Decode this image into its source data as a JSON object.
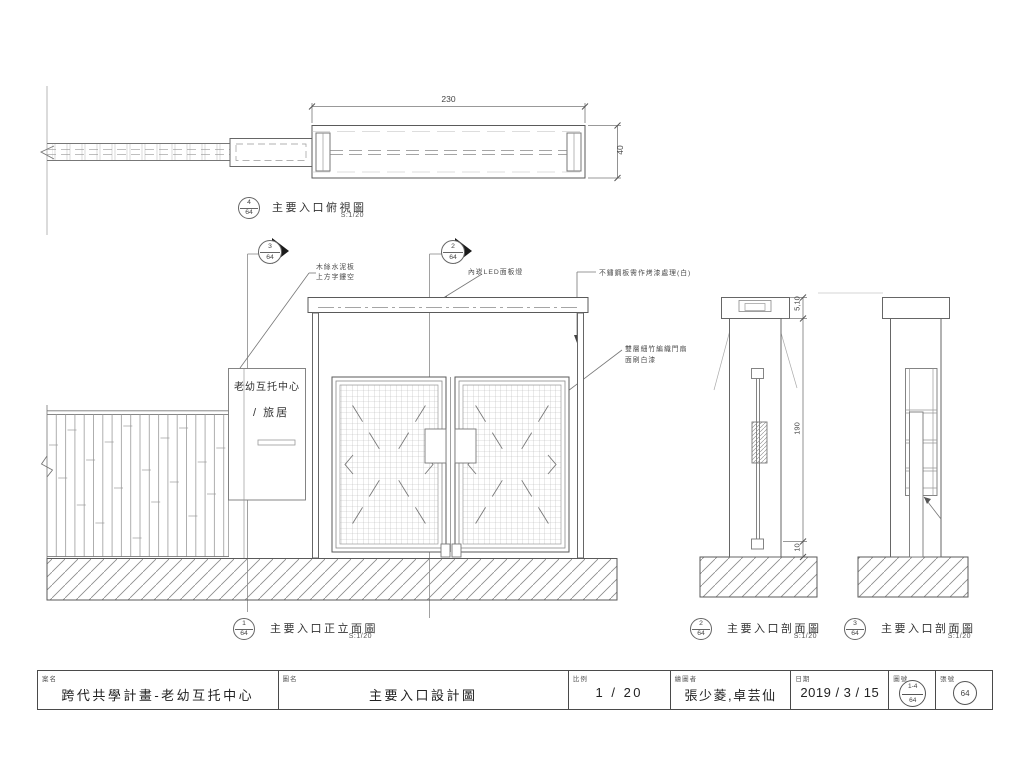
{
  "plan": {
    "title": "主要入口俯視圖",
    "scale": "S:1/20",
    "ref_top": "4",
    "ref_bottom": "64",
    "dim_width": "230",
    "dim_depth": "40"
  },
  "markers": {
    "m3": {
      "top": "3",
      "bottom": "64"
    },
    "m2": {
      "top": "2",
      "bottom": "64"
    }
  },
  "annotations": {
    "cement1": "木絲水泥板",
    "cement2": "上方字鏤空",
    "led": "內崁LED面板燈",
    "stainless": "不鏽鋼板需作烤漆處理(白)",
    "bamboo1": "雙層細竹編織門扇",
    "bamboo2": "面刷白漆"
  },
  "sign": {
    "line1": "老幼互托中心",
    "line2": "/ 旅居"
  },
  "elevation": {
    "title": "主要入口正立面圖",
    "scale": "S:1/20",
    "ref_top": "1",
    "ref_bottom": "64"
  },
  "section2": {
    "title": "主要入口剖面圖",
    "scale": "S:1/20",
    "ref_top": "2",
    "ref_bottom": "64",
    "dim_top": "5,10",
    "dim_mid": "190",
    "dim_bottom": "10"
  },
  "section3": {
    "title": "主要入口剖面圖",
    "scale": "S:1/20",
    "ref_top": "3",
    "ref_bottom": "64"
  },
  "titleblock": {
    "project_label": "案名",
    "project_value": "跨代共學計畫-老幼互托中心",
    "drawing_label": "圖名",
    "drawing_value": "主要入口設計圖",
    "scale_label": "比例",
    "scale_value": "1 / 20",
    "drafter_label": "繪圖者",
    "drafter_value": "張少菱,卓芸仙",
    "date_label": "日期",
    "date_value": "2019 / 3 / 15",
    "dwg_no_label": "圖號",
    "dwg_no_top": "1-4",
    "dwg_no_bottom": "64",
    "sheet_label": "張號",
    "sheet_value": "64"
  }
}
